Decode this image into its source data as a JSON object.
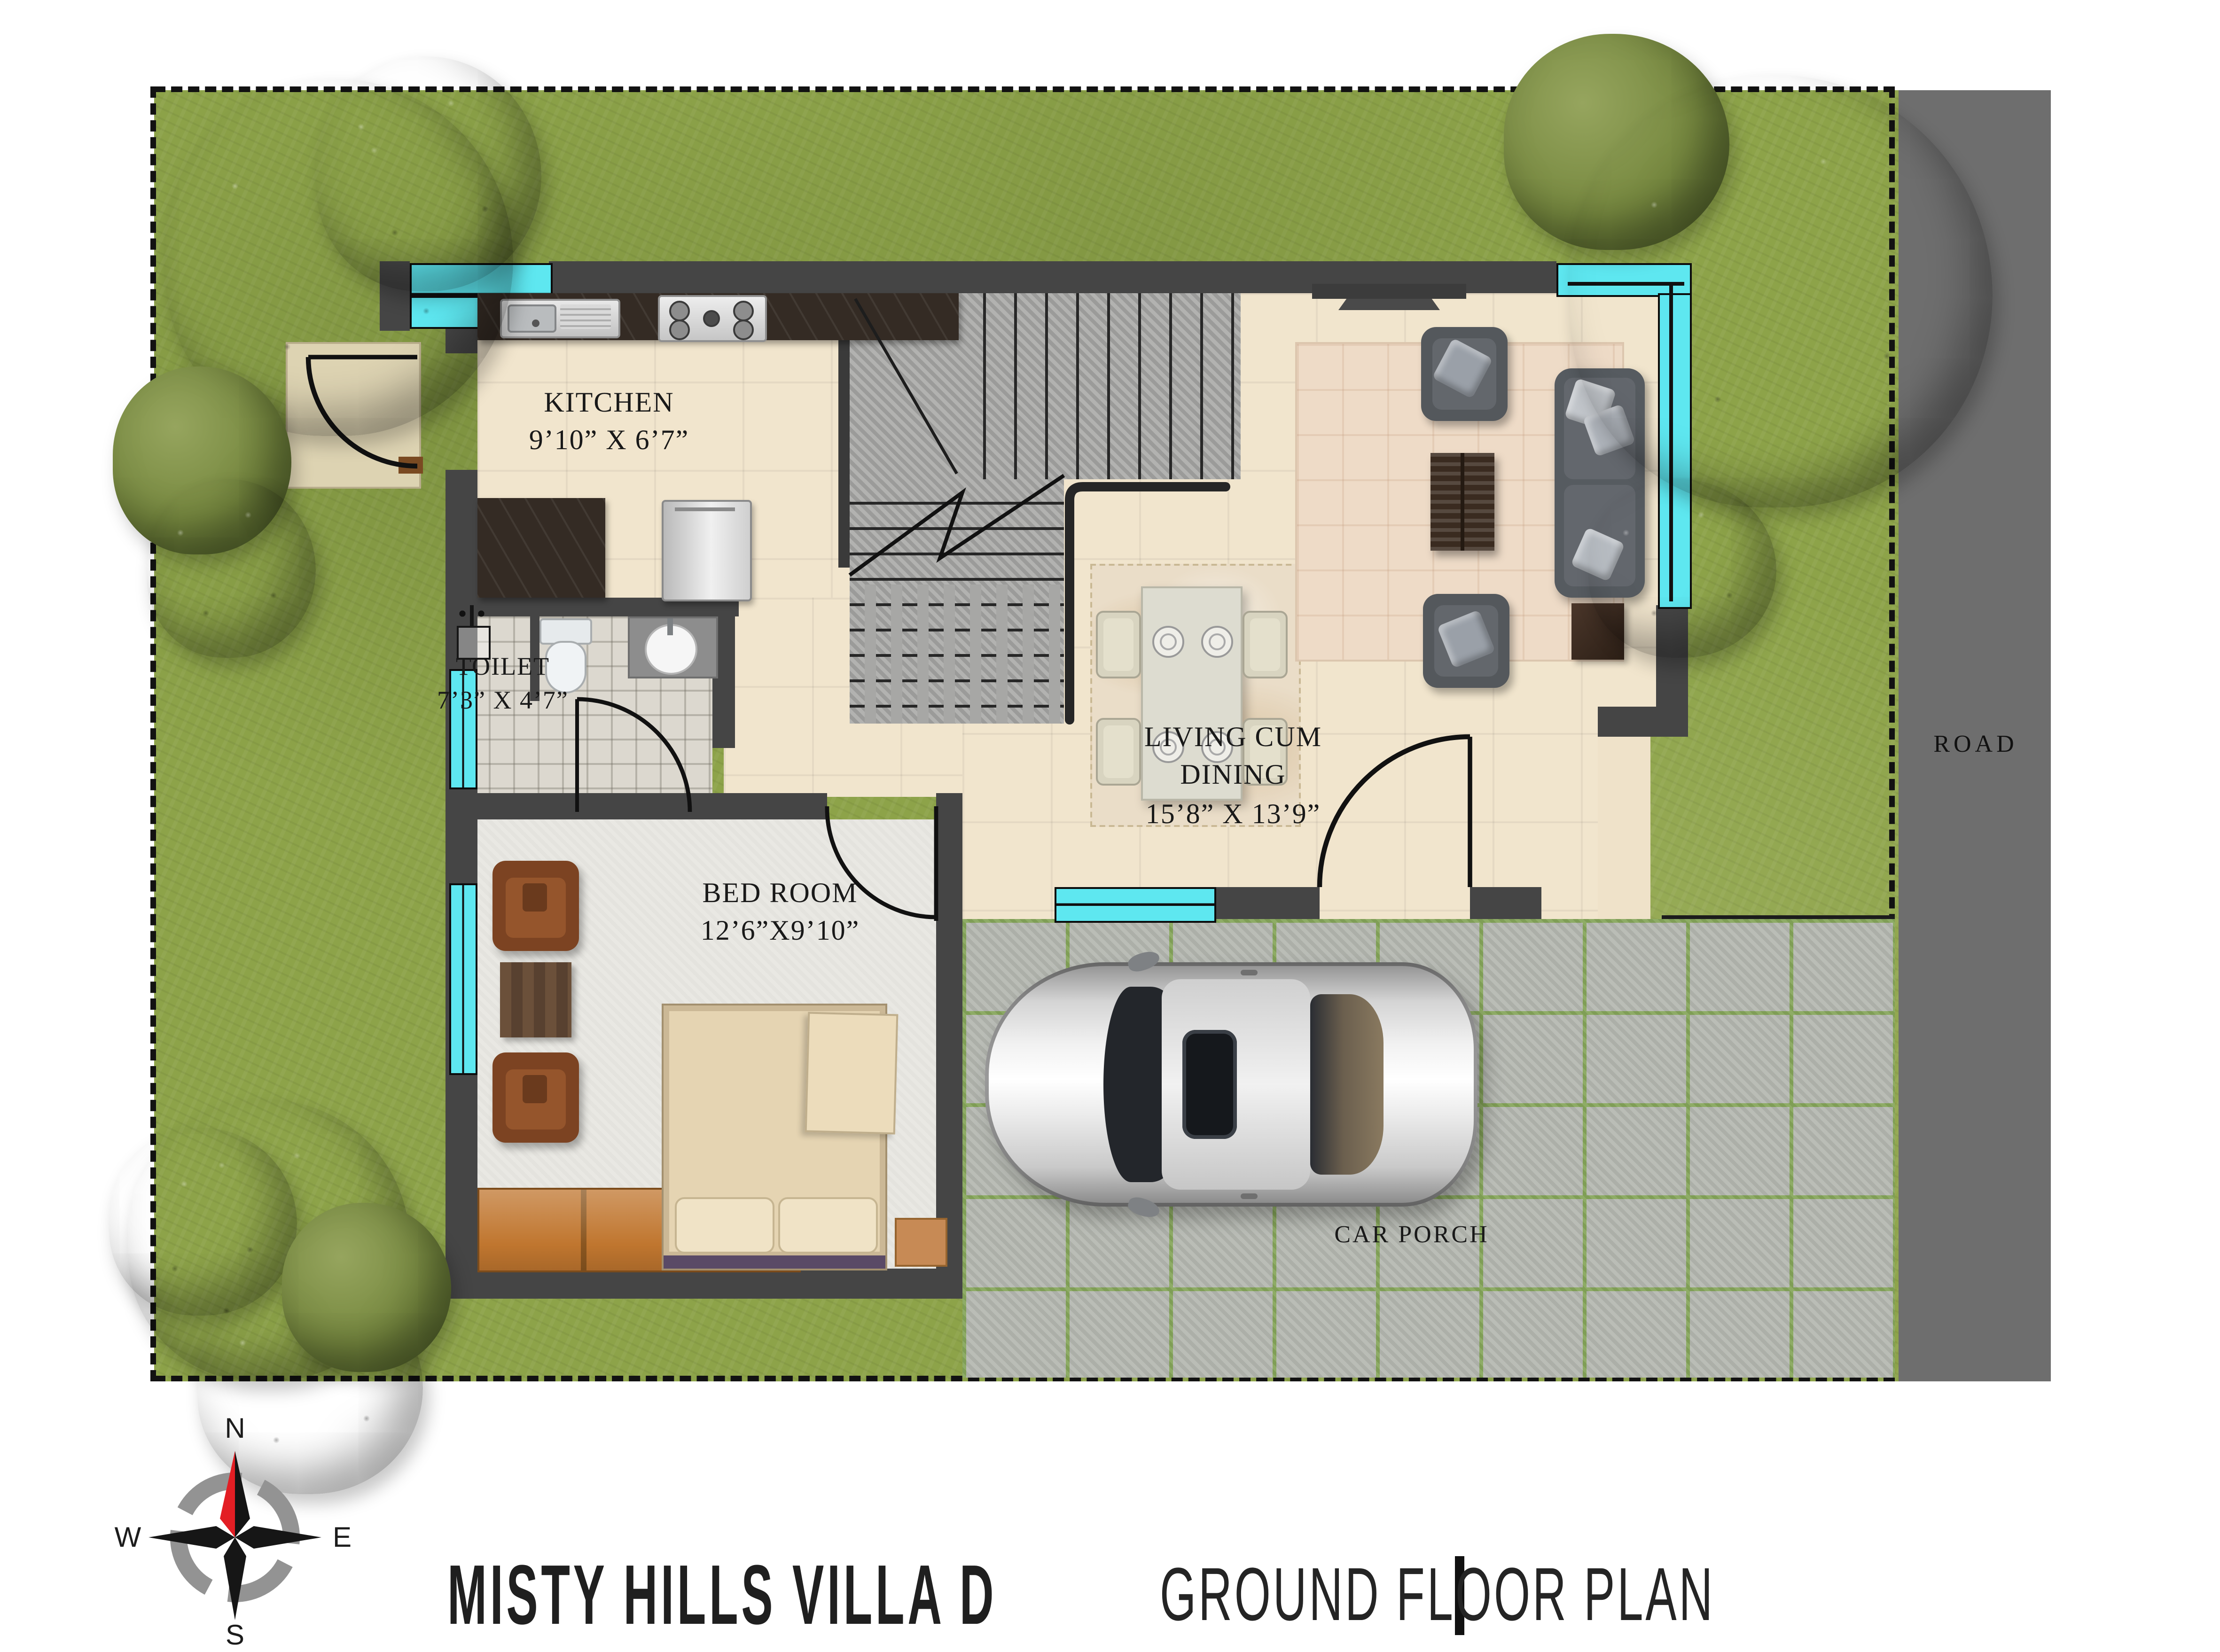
{
  "title": {
    "project": "MISTY HILLS VILLA  D",
    "separator": "|",
    "plan_type": "GROUND FLOOR PLAN"
  },
  "site": {
    "road_label": "ROAD",
    "car_porch_label": "CAR PORCH"
  },
  "compass": {
    "north": "N",
    "south": "S",
    "east": "E",
    "west": "W"
  },
  "rooms": {
    "kitchen": {
      "name": "KITCHEN",
      "dimensions": "9’10” X 6’7”"
    },
    "toilet": {
      "name": "TOILET",
      "dimensions": "7’3” X 4’7”"
    },
    "living_dining": {
      "name_line1": "LIVING CUM",
      "name_line2": "DINING",
      "dimensions": "15’8” X 13’9”"
    },
    "bedroom": {
      "name": "BED ROOM",
      "dimensions": "12’6”X9’10”"
    }
  },
  "colors": {
    "window_accent": "#5ee7f0",
    "lawn": "#8da349",
    "road": "#6e6e6e",
    "wall": "#454545",
    "floor_cream": "#f1e5cd",
    "porch_tile": "#b5b8b1",
    "porch_grout": "#86a65a"
  }
}
